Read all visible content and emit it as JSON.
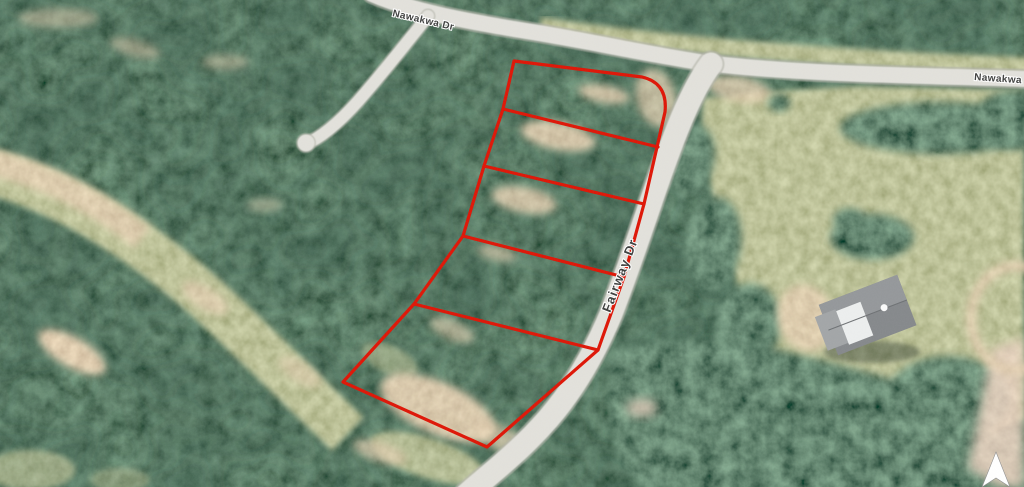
{
  "map": {
    "type": "satellite-aerial-parcel-view",
    "labels": {
      "top_road": "Nawakwa Dr",
      "right_road": "Nawakwa Dr",
      "main_road": "Fairway Dr"
    },
    "parcel": {
      "lot_count": 5,
      "outline_color": "#de1506",
      "outline_path": "M 514,61 L 642,77 Q 668,83 665,112 L 644,204 L 624,277 L 598,350 L 487,447 L 343,382 L 414,304 L 463,236 L 484,166 L 503,109 Z",
      "divider_paths": "M 503,109 L 658,147 M 484,166 L 644,204 M 463,236 L 624,277 M 414,304 L 598,350"
    },
    "compass": {
      "points": "996,452 1010,487 996,478 982,487",
      "direction": "north"
    },
    "palette": {
      "forest": "#1e2d21",
      "grass": "#7d8a5a",
      "dirt": "#c3a276",
      "road": "#e2e1db",
      "outline": "#de1506",
      "label_text": "#3e3f3e"
    }
  }
}
